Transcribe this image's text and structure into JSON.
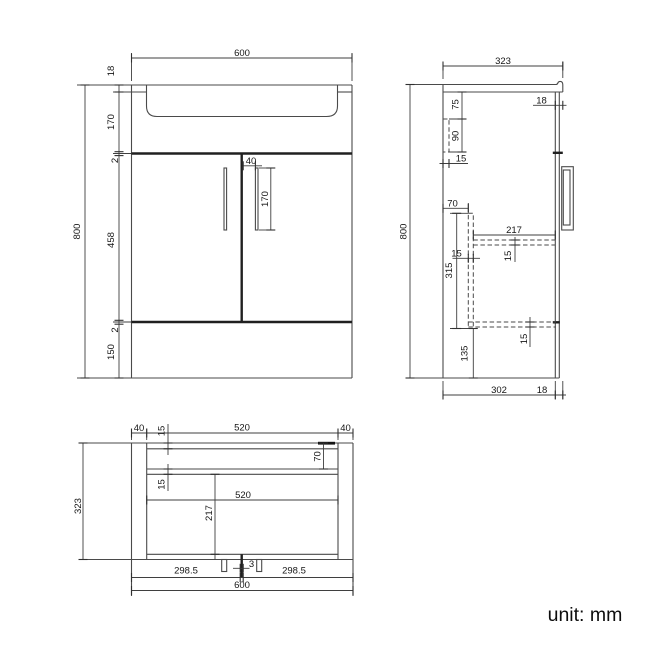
{
  "unit_label": "unit: mm",
  "front_view": {
    "width": "600",
    "height": "800",
    "counter_thickness": "18",
    "basin_depth": "170",
    "top_gap": "2",
    "door_height": "458",
    "bottom_gap": "2",
    "plinth_height": "150",
    "handle_offset": "40",
    "handle_height": "170"
  },
  "side_view": {
    "depth": "323",
    "height": "800",
    "counter_front_gap": "18",
    "rail_top_offset": "75",
    "rail_height": "90",
    "rail_thickness": "15",
    "divider_offset": "70",
    "divider_height": "315",
    "divider_thickness": "15",
    "shelf_depth": "217",
    "shelf_thickness": "15",
    "bottom_panel_thickness": "15",
    "bottom_clearance": "135",
    "body_depth": "302",
    "front_gap": "18"
  },
  "plan_view": {
    "left_panel": "40",
    "opening_width": "520",
    "right_panel": "40",
    "back_rail_thickness": "15",
    "back_rail_offset": "70",
    "mid_rail_thickness": "15",
    "inner_width": "520",
    "shelf_depth": "217",
    "door_left": "298.5",
    "door_gap": "3",
    "door_right": "298.5",
    "width": "600",
    "depth": "323"
  }
}
